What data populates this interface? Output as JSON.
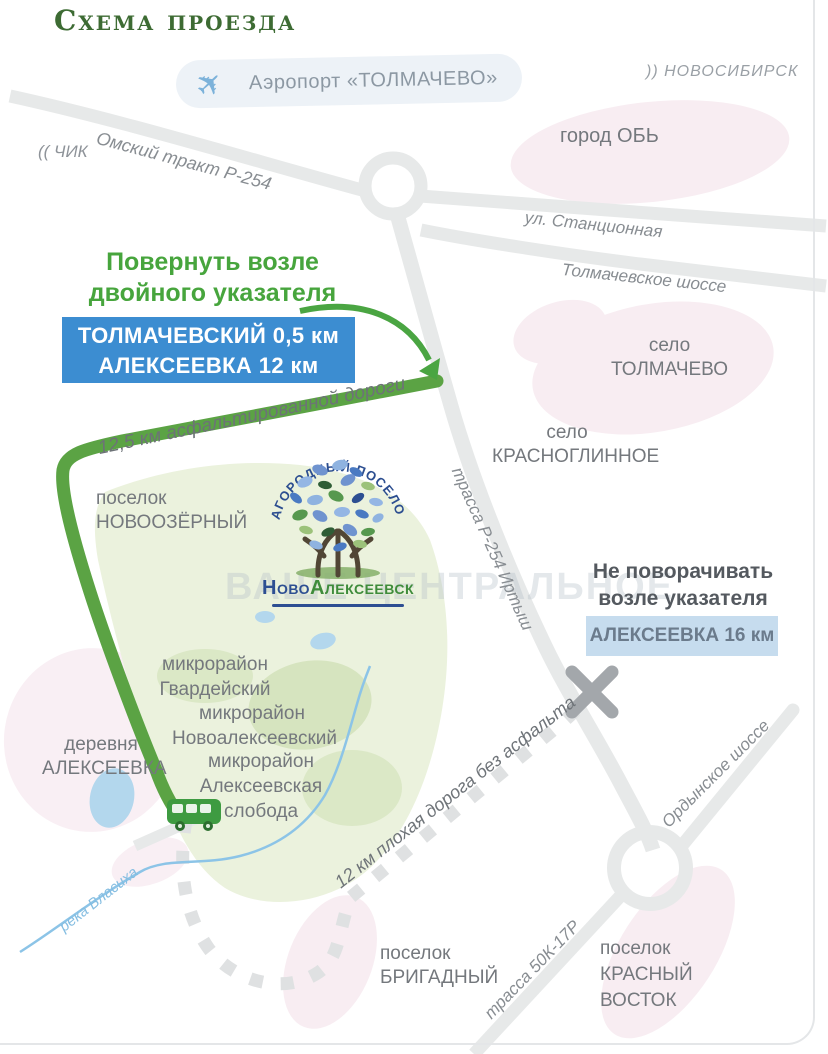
{
  "title": "Схема проезда",
  "watermark": "ВАШЕ ЦЕНТРАЛЬНОЕ",
  "airport": {
    "icon": "✈",
    "label": "Аэропорт «ТОЛМАЧЕВО»"
  },
  "offmap": {
    "novosibirsk": ")) НОВОСИБИРСК",
    "chik": "(( ЧИК"
  },
  "roads": {
    "omsky_trakt": "Омский тракт Р-254",
    "stantsionnaya": "ул. Станционная",
    "tolmachevskoe_shosse": "Толмачевское шоссе",
    "r254": "трасса Р-254 Иртыш",
    "asphalt": "12,5 км асфальтированной дороги",
    "dirt": "12 км плохая  дорога без асфальта",
    "ordynskoe": "Ордынское шоссе",
    "k50_17r": "трасса 50К-17Р",
    "river": "река Власиха"
  },
  "callouts": {
    "turn": [
      "Повернуть возле",
      "двойного указателя"
    ],
    "sign_turn": [
      "ТОЛМАЧЕВСКИЙ 0,5 км",
      "АЛЕКСЕЕВКА 12 км"
    ],
    "no_turn": [
      "Не поворачивать",
      "возле указателя"
    ],
    "sign_no_turn": "АЛЕКСЕЕВКА 16 км"
  },
  "places": {
    "ob": "город ОБЬ",
    "tolmachevo": [
      "село",
      "ТОЛМАЧЕВО"
    ],
    "krasnoglinnoe": [
      "село",
      "КРАСНОГЛИННОЕ"
    ],
    "novoozerny": [
      "поселок",
      "НОВООЗЁРНЫЙ"
    ],
    "alekseevka": [
      "деревня",
      "АЛЕКСЕЕВКА"
    ],
    "gvardeysky": [
      "микрорайон",
      "Гвардейский"
    ],
    "novoalekseevsky": [
      "микрорайон",
      "Новоалексеевский"
    ],
    "sloboda": [
      "микрорайон",
      "Алексеевская",
      "слобода"
    ],
    "brigadny": [
      "поселок",
      "БРИГАДНЫЙ"
    ],
    "krasny_vostok": [
      "поселок",
      "КРАСНЫЙ",
      "ВОСТОК"
    ]
  },
  "logo": {
    "arc": "ЗАГОРОДНЫЙ ПОСЕЛОК",
    "name_1": "Ново",
    "name_2": "Алексеевск"
  },
  "colors": {
    "title_green": "#3d6b33",
    "heading_green": "#47a53d",
    "green_road": "#5ba344",
    "sign_blue": "#3c8dd1",
    "sign_light_blue": "#c6dcee",
    "pink_area": "#f8edf2",
    "village_green": "#ebf2dd",
    "river_blue": "#8cc4e7",
    "road_gray": "#e7e9e9"
  }
}
